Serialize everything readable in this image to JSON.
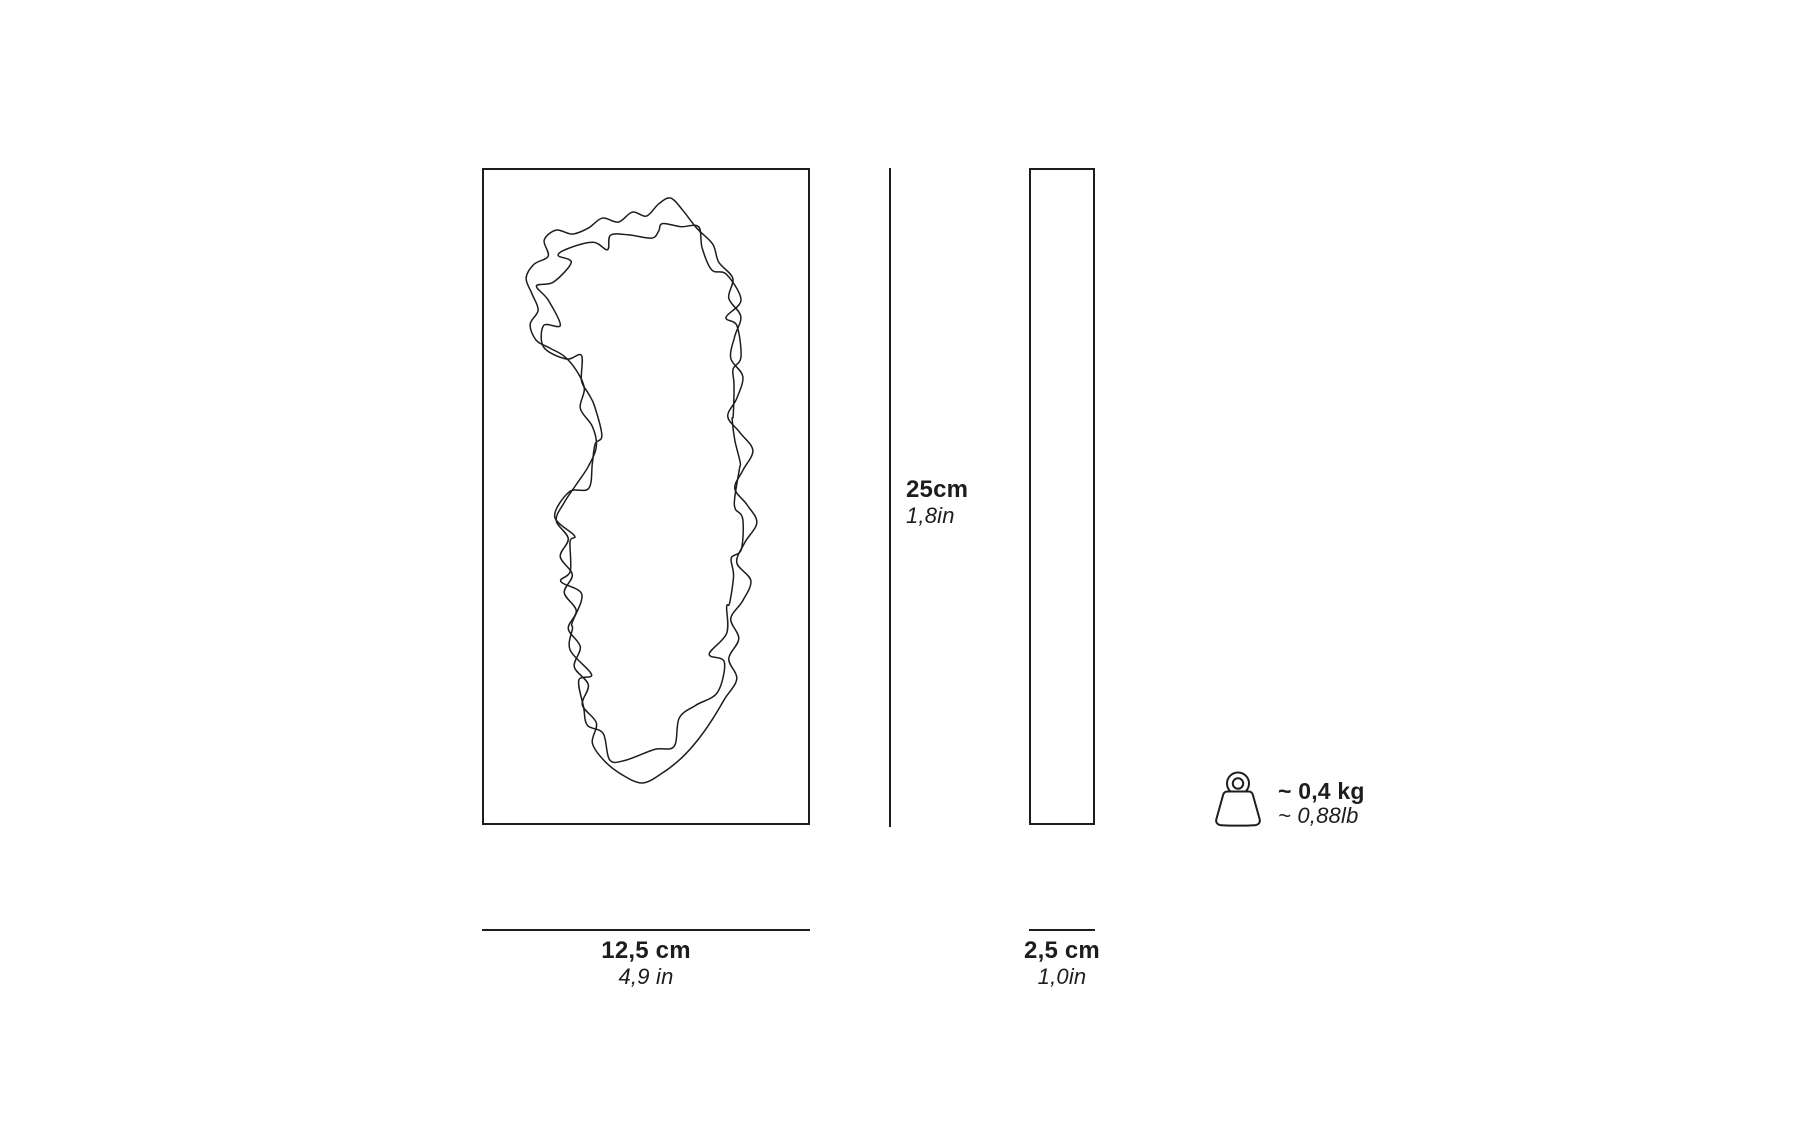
{
  "diagram": {
    "title": "product-dimension-diagram",
    "colors": {
      "ink": "#1d1d1b",
      "background": "#ffffff"
    },
    "front_view": {
      "height_metric": "25cm",
      "height_imperial": "1,8in",
      "width_metric": "12,5 cm",
      "width_imperial": "4,9 in"
    },
    "side_view": {
      "width_metric": "2,5 cm",
      "width_imperial": "1,0in"
    },
    "weight": {
      "metric": "~ 0,4 kg",
      "imperial": "~ 0,88lb",
      "icon": "weight-icon"
    }
  }
}
